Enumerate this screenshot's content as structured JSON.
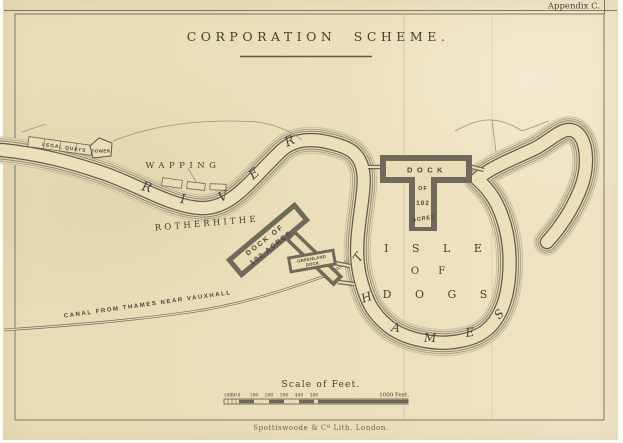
{
  "page": {
    "appendix": "Appendix C.",
    "title": "CORPORATION SCHEME.",
    "imprint": "Spottiswoode & Cº Lith. London."
  },
  "map": {
    "labels": {
      "legal_quays": "LEGAL QUAYS",
      "tower": "TOWER",
      "wapping": "WAPPING",
      "rotherhithe": "ROTHERHITHE",
      "canal": "CANAL FROM THAMES NEAR VAUXHALL",
      "river": [
        "R",
        "I",
        "V",
        "E",
        "R"
      ],
      "thames": [
        "T",
        "H",
        "A",
        "M",
        "E",
        "S"
      ],
      "isle": {
        "l1": "I S L E",
        "l2": "O F",
        "l3": "D O G S"
      },
      "dock_rotherhithe": {
        "l1": "DOCK OF",
        "l2": "102 ACRES"
      },
      "dock_isle_of_dogs": {
        "l1": "DOCK",
        "l2": "OF",
        "l3": "102",
        "l4": "ACRES"
      },
      "dock_greenland": {
        "l1": "GREENLAND",
        "l2": "DOCK"
      }
    },
    "scale": {
      "title": "Scale of Feet.",
      "sub_ticks": [
        "100",
        "50",
        "0"
      ],
      "ticks": [
        "100",
        "200",
        "300",
        "400",
        "500"
      ],
      "end_label": "1000 Feet."
    },
    "colors": {
      "paper": "#ecdfbc",
      "ink": "#45412f",
      "bank_line": "#5f5a4c",
      "dock_wall": "#6f6a59"
    }
  }
}
